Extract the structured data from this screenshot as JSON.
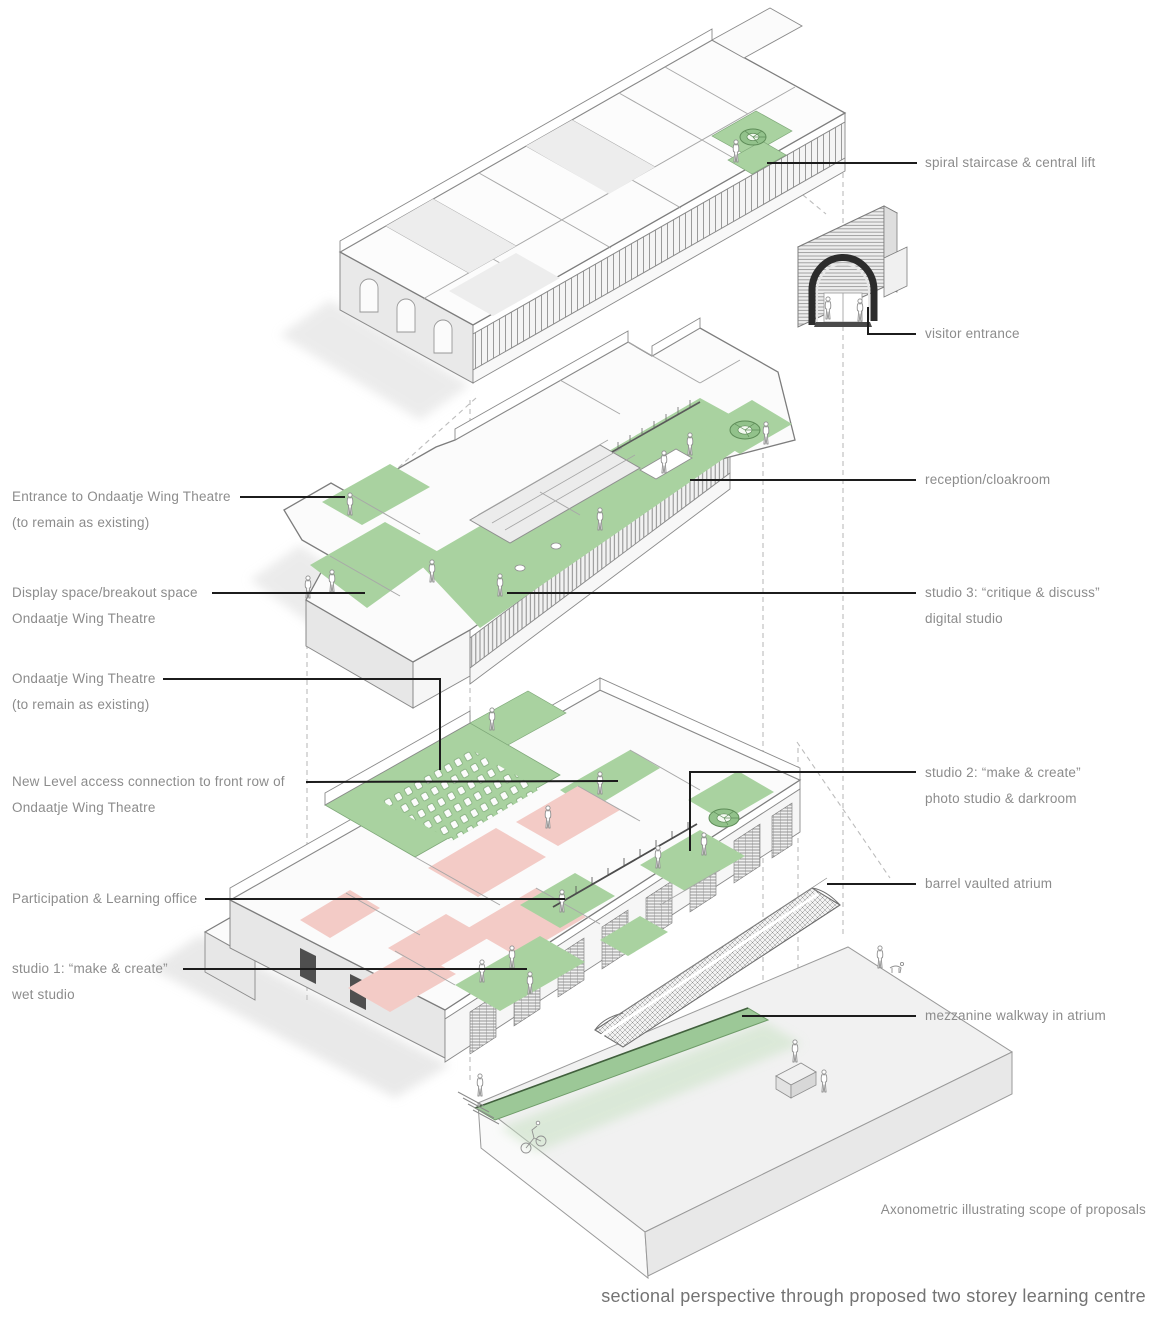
{
  "diagram": {
    "type": "exploded axonometric architectural diagram",
    "colors": {
      "proposed_green": "#a9d2a0",
      "retained_pink": "#f3cbc6",
      "leader_line": "#1c1c1c",
      "label_text": "#8c8c8c",
      "linework_grey": "#8a8a8a"
    },
    "labels": {
      "entrance": {
        "l1": "Entrance to Ondaatje Wing Theatre",
        "l2": "(to remain as existing)"
      },
      "display": {
        "l1": "Display space/breakout space",
        "l2": "Ondaatje Wing Theatre"
      },
      "theatre": {
        "l1": "Ondaatje Wing Theatre",
        "l2": "(to remain as existing)"
      },
      "access": {
        "l1": "New Level access connection to front row of",
        "l2": "Ondaatje Wing Theatre"
      },
      "participation": {
        "l1": "Participation & Learning office"
      },
      "studio1": {
        "l1": "studio 1: “make & create”",
        "l2": "wet studio"
      },
      "spiral": {
        "l1": "spiral staircase & central lift"
      },
      "visitor": {
        "l1": "visitor entrance"
      },
      "reception": {
        "l1": "reception/cloakroom"
      },
      "studio3": {
        "l1": "studio 3: “critique & discuss”",
        "l2": "digital studio"
      },
      "studio2": {
        "l1": "studio 2: “make & create”",
        "l2": "photo studio & darkroom"
      },
      "vault": {
        "l1": "barrel vaulted atrium"
      },
      "mezzanine": {
        "l1": "mezzanine walkway in atrium"
      }
    },
    "captions": {
      "axon_note": "Axonometric illustrating scope of proposals",
      "main_title": "sectional perspective through proposed two storey learning centre"
    },
    "levels": [
      "upper floor (existing galleries, spiral staircase & central lift)",
      "middle floor (entrance level: reception, studio 3, Ondaatje Wing Theatre entrance)",
      "lower floor (theatre, studios 1 & 2, Participation & Learning office)",
      "atrium: barrel vault, mezzanine walkway, ground slab"
    ]
  }
}
